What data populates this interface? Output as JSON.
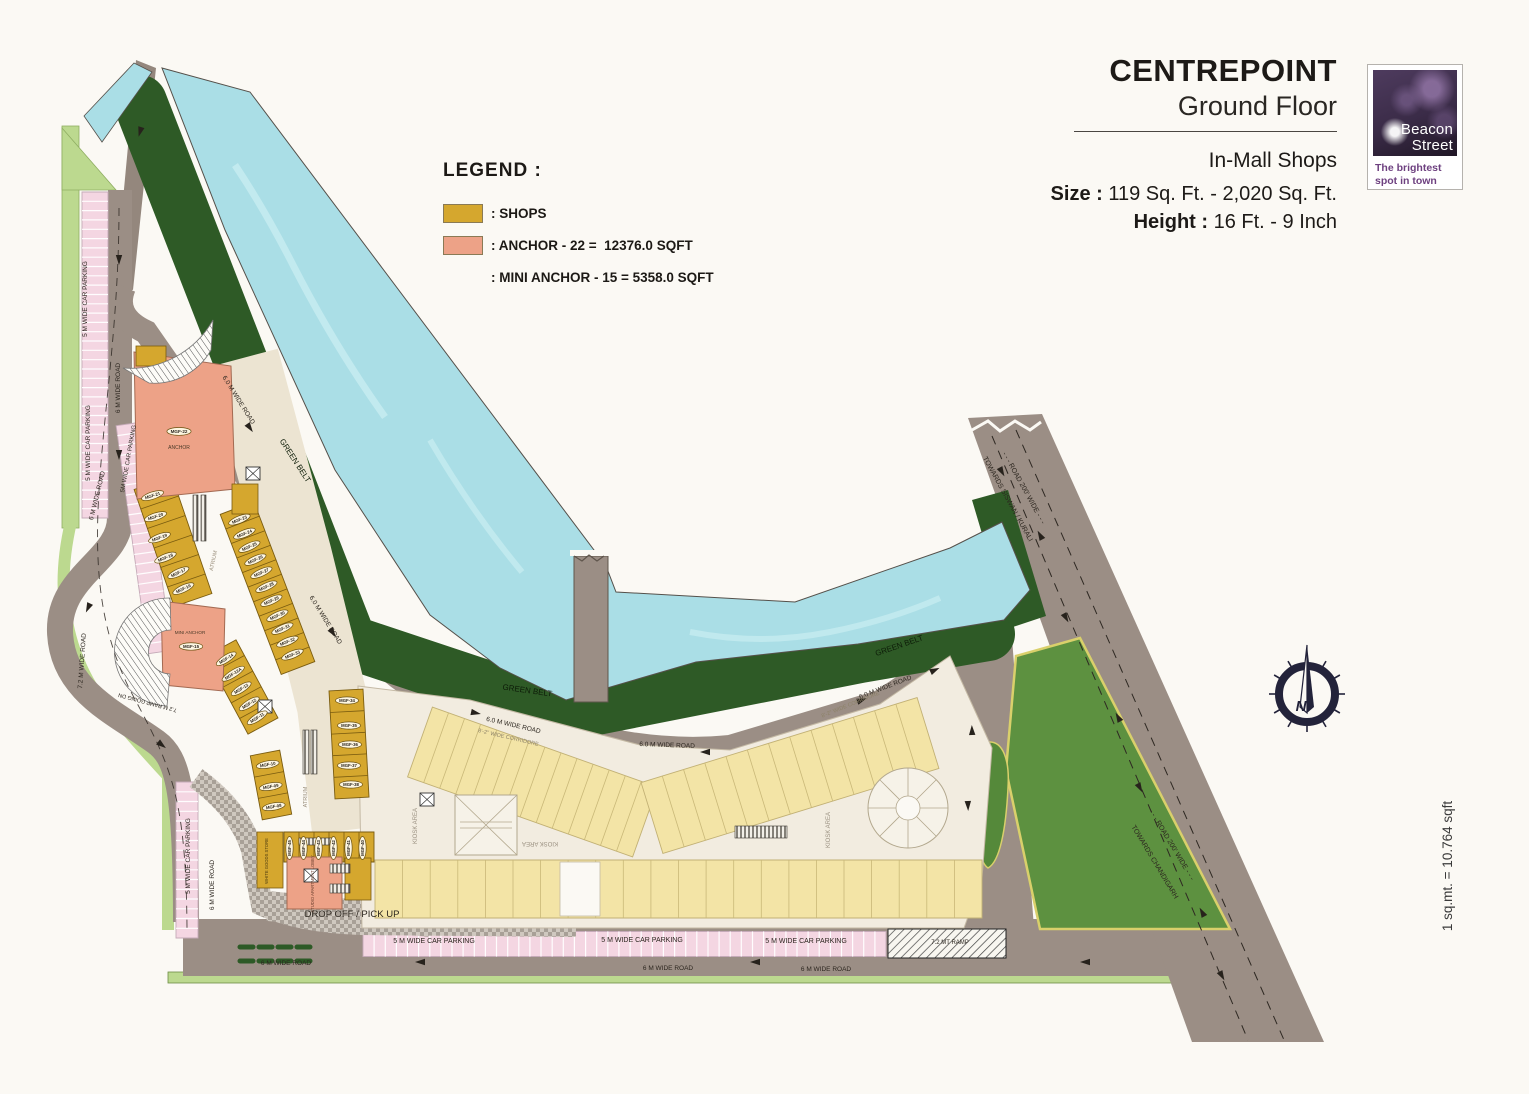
{
  "header": {
    "title": "CENTREPOINT",
    "subtitle": "Ground Floor",
    "category": "In-Mall Shops",
    "size_label": "Size :",
    "size_value": " 119 Sq. Ft. - 2,020 Sq. Ft.",
    "height_label": "Height :",
    "height_value": " 16 Ft. - 9 Inch"
  },
  "logo": {
    "line1": "Beacon",
    "line2": "Street",
    "tagline_line1": "The brightest",
    "tagline_line2": "spot in town"
  },
  "legend": {
    "title": "LEGEND :",
    "items": [
      {
        "swatch": "#d5a72e",
        "label": ": SHOPS"
      },
      {
        "swatch": "#eda287",
        "label": ": ANCHOR - 22 =  12376.0 SQFT"
      },
      {
        "swatch": "",
        "label": ": MINI ANCHOR - 15 = 5358.0 SQFT"
      }
    ]
  },
  "compass": {
    "letter": "N"
  },
  "scale_note": "1 sq.mt. = 10.764 sqft",
  "colors": {
    "shops": "#d5a72e",
    "anchor": "#eda287",
    "water": "#aadee6",
    "green_belt": "#2e5a26",
    "road": "#9b8e85",
    "parking": "#f4d6e2",
    "lawn": "#5d9140",
    "small_shops": "#f3e4a6"
  },
  "plan": {
    "labels": [
      {
        "t": "MGF-22",
        "x": 179,
        "y": 433,
        "o": 1,
        "s": 4.6
      },
      {
        "t": "ANCHOR",
        "x": 179,
        "y": 449,
        "s": 5,
        "c": "#4a3a28"
      },
      {
        "t": "MINI ANCHOR",
        "x": 190,
        "y": 634,
        "s": 4.6,
        "c": "#4a3a28"
      },
      {
        "t": "MGF-15",
        "x": 191,
        "y": 648,
        "o": 1,
        "s": 4.4
      },
      {
        "t": "MGF-21",
        "x": 153,
        "y": 497,
        "r": -18,
        "o": 1
      },
      {
        "t": "MGF-20",
        "x": 156,
        "y": 518,
        "r": -18,
        "o": 1
      },
      {
        "t": "MGF-19",
        "x": 160,
        "y": 539,
        "r": -20,
        "o": 1
      },
      {
        "t": "MGF-18",
        "x": 166,
        "y": 559,
        "r": -22,
        "o": 1
      },
      {
        "t": "MGF-17",
        "x": 179,
        "y": 574,
        "r": -25,
        "o": 1
      },
      {
        "t": "MGF-16",
        "x": 184,
        "y": 590,
        "r": -25,
        "o": 1
      },
      {
        "t": "MGF-23",
        "x": 240,
        "y": 521,
        "r": -22,
        "o": 1
      },
      {
        "t": "MGF-24",
        "x": 245,
        "y": 535,
        "r": -22,
        "o": 1
      },
      {
        "t": "MGF-25",
        "x": 250,
        "y": 548,
        "r": -24,
        "o": 1
      },
      {
        "t": "MGF-26",
        "x": 256,
        "y": 561,
        "r": -24,
        "o": 1
      },
      {
        "t": "MGF-27",
        "x": 262,
        "y": 574,
        "r": -24,
        "o": 1
      },
      {
        "t": "MGF-28",
        "x": 267,
        "y": 588,
        "r": -24,
        "o": 1
      },
      {
        "t": "MGF-29",
        "x": 272,
        "y": 602,
        "r": -24,
        "o": 1
      },
      {
        "t": "MGF-30",
        "x": 278,
        "y": 617,
        "r": -24,
        "o": 1
      },
      {
        "t": "MGF-31",
        "x": 283,
        "y": 630,
        "r": -24,
        "o": 1
      },
      {
        "t": "MGF-32",
        "x": 288,
        "y": 643,
        "r": -22,
        "o": 1
      },
      {
        "t": "MGF-33",
        "x": 293,
        "y": 656,
        "r": -22,
        "o": 1
      },
      {
        "t": "MGF-34",
        "x": 347,
        "y": 702,
        "o": 1
      },
      {
        "t": "MGF-35",
        "x": 349,
        "y": 727,
        "o": 1
      },
      {
        "t": "MGF-36",
        "x": 350,
        "y": 746,
        "o": 1
      },
      {
        "t": "MGF-37",
        "x": 349,
        "y": 767,
        "o": 1
      },
      {
        "t": "MGF-38",
        "x": 351,
        "y": 786,
        "o": 1
      },
      {
        "t": "MGF-14",
        "x": 227,
        "y": 660,
        "r": -32,
        "o": 1
      },
      {
        "t": "MGF-12A",
        "x": 234,
        "y": 675,
        "r": -32,
        "o": 1
      },
      {
        "t": "MGF-13",
        "x": 242,
        "y": 690,
        "r": -32,
        "o": 1
      },
      {
        "t": "MGF-12",
        "x": 250,
        "y": 705,
        "r": -32,
        "o": 1
      },
      {
        "t": "MGF-11",
        "x": 258,
        "y": 719,
        "r": -32,
        "o": 1
      },
      {
        "t": "MGF-10",
        "x": 268,
        "y": 766,
        "r": -10,
        "o": 1
      },
      {
        "t": "MGF-09",
        "x": 271,
        "y": 788,
        "r": -10,
        "o": 1
      },
      {
        "t": "MGF-08",
        "x": 274,
        "y": 808,
        "r": -10,
        "o": 1
      },
      {
        "t": "MGF-45",
        "x": 291,
        "y": 848,
        "r": -90,
        "o": 1
      },
      {
        "t": "MGF-44",
        "x": 305,
        "y": 848,
        "r": -90,
        "o": 1
      },
      {
        "t": "MGF-43",
        "x": 320,
        "y": 848,
        "r": -90,
        "o": 1
      },
      {
        "t": "MGF-42",
        "x": 335,
        "y": 848,
        "r": -90,
        "o": 1
      },
      {
        "t": "MGF-41",
        "x": 350,
        "y": 848,
        "r": -90,
        "o": 1
      },
      {
        "t": "MGF-40",
        "x": 364,
        "y": 848,
        "r": -90,
        "o": 1
      },
      {
        "t": "STUDIO APARTMENT LOBBY",
        "x": 314,
        "y": 884,
        "r": -90,
        "s": 4.2,
        "c": "#6b3f2e"
      },
      {
        "t": "WHITE GOODS STORE",
        "x": 268,
        "y": 861,
        "r": -90,
        "s": 4.2,
        "c": "#4a3a10"
      },
      {
        "t": "5 M WIDE CAR PARKING",
        "x": 87,
        "y": 299,
        "r": -90,
        "s": 6.5
      },
      {
        "t": "5 M WIDE CAR PARKING",
        "x": 90,
        "y": 443,
        "r": -90,
        "s": 6.5
      },
      {
        "t": "6 M WIDE ROAD",
        "x": 120,
        "y": 388,
        "r": -90,
        "s": 6.5
      },
      {
        "t": "5M WIDE CAR PARKING",
        "x": 130,
        "y": 459,
        "r": -80,
        "s": 6
      },
      {
        "t": "6 M WIDE ROAD",
        "x": 99,
        "y": 496,
        "r": -76,
        "s": 6.5
      },
      {
        "t": "7.2 M WIDE ROAD",
        "x": 84,
        "y": 661,
        "r": -86,
        "s": 6.5
      },
      {
        "t": "7.2 M RAMP GOING DN",
        "x": 148,
        "y": 701,
        "r": 195,
        "s": 5.5
      },
      {
        "t": "5 M WIDE CAR PARKING",
        "x": 190,
        "y": 856,
        "r": -90,
        "s": 6.5
      },
      {
        "t": "6 M WIDE ROAD",
        "x": 214,
        "y": 885,
        "r": -90,
        "s": 6.5
      },
      {
        "t": "6.0 M WIDE ROAD",
        "x": 237,
        "y": 401,
        "r": 58,
        "s": 6.5
      },
      {
        "t": "6.0 M WIDE ROAD",
        "x": 324,
        "y": 621,
        "r": 58,
        "s": 6.5
      },
      {
        "t": "6.0 M WIDE ROAD",
        "x": 513,
        "y": 727,
        "r": 13,
        "s": 6.5
      },
      {
        "t": "6.0 M WIDE ROAD",
        "x": 667,
        "y": 747,
        "r": 2,
        "s": 6.5
      },
      {
        "t": "6.0 M WIDE ROAD",
        "x": 886,
        "y": 689,
        "r": -21,
        "s": 6.5
      },
      {
        "t": "GREEN BELT",
        "x": 293,
        "y": 462,
        "r": 57,
        "s": 8,
        "c": "#0d1c08"
      },
      {
        "t": "GREEN BELT",
        "x": 527,
        "y": 693,
        "r": 8,
        "s": 8,
        "c": "#0d1c08"
      },
      {
        "t": "GREEN BELT",
        "x": 900,
        "y": 648,
        "r": -19,
        "s": 8,
        "c": "#0d1c08"
      },
      {
        "t": "8'-2\" WIDE CORRIDORE",
        "x": 508,
        "y": 739,
        "r": 13,
        "s": 5.5,
        "c": "#8d8268"
      },
      {
        "t": "8'-2\" WIDE CORRIDORE",
        "x": 851,
        "y": 706,
        "r": -22,
        "s": 5.5,
        "c": "#8d8268"
      },
      {
        "t": "KIOSK AREA",
        "x": 417,
        "y": 826,
        "r": -90,
        "s": 6,
        "c": "#9a9080"
      },
      {
        "t": "KIOSK AREA",
        "x": 540,
        "y": 842,
        "r": 180,
        "s": 6,
        "c": "#9a9080"
      },
      {
        "t": "KIOSK AREA",
        "x": 830,
        "y": 830,
        "r": -90,
        "s": 6,
        "c": "#9a9080"
      },
      {
        "t": "ATRIUM",
        "x": 215,
        "y": 561,
        "r": -78,
        "s": 5.5,
        "c": "#9a8f7c"
      },
      {
        "t": "ATRIUM",
        "x": 307,
        "y": 797,
        "r": -90,
        "s": 5.5,
        "c": "#9a8f7c"
      },
      {
        "t": "DROP OFF / PICK UP",
        "x": 352,
        "y": 917,
        "s": 9.5,
        "c": "#2a241d"
      },
      {
        "t": "5 M WIDE CAR PARKING",
        "x": 434,
        "y": 943,
        "s": 7
      },
      {
        "t": "5 M WIDE CAR PARKING",
        "x": 642,
        "y": 942,
        "s": 7
      },
      {
        "t": "5 M WIDE CAR PARKING",
        "x": 806,
        "y": 943,
        "s": 7
      },
      {
        "t": "7.2 MT RAMP",
        "x": 950,
        "y": 944,
        "s": 6
      },
      {
        "t": "6 M WIDE ROAD",
        "x": 286,
        "y": 965,
        "s": 6.5
      },
      {
        "t": "6 M WIDE ROAD",
        "x": 668,
        "y": 970,
        "s": 6.5
      },
      {
        "t": "6 M WIDE ROAD",
        "x": 826,
        "y": 971,
        "s": 6.5
      },
      {
        "t": "- - - ROAD 200' WIDE - - -",
        "x": 1022,
        "y": 489,
        "r": 61,
        "s": 7
      },
      {
        "t": "TOWARDS SISWAN / KURALI",
        "x": 1006,
        "y": 500,
        "r": 61,
        "s": 7
      },
      {
        "t": "- - - ROAD 200' WIDE - - -",
        "x": 1170,
        "y": 846,
        "r": 59,
        "s": 7
      },
      {
        "t": "TOWARDS CHANDIGARH",
        "x": 1153,
        "y": 863,
        "r": 59,
        "s": 7
      },
      {
        "t": "1 sq.mt. = 10.764 sqft",
        "x": 1452,
        "y": 866,
        "r": -90,
        "s": 13.5,
        "c": "#3a3a3a"
      }
    ]
  }
}
